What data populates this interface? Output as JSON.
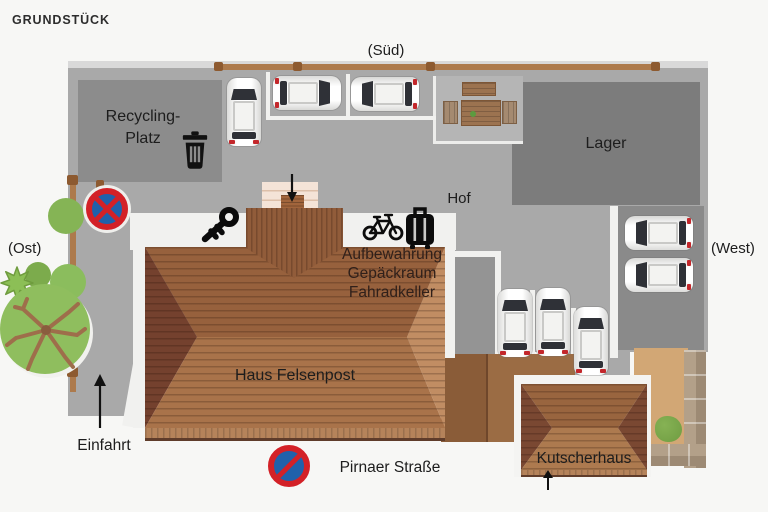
{
  "title": "GRUNDSTÜCK",
  "compass": {
    "south": "(Süd)",
    "east": "(Ost)",
    "west": "(West)"
  },
  "labels": {
    "recycling": [
      "Recycling-",
      "Platz"
    ],
    "lager": "Lager",
    "hof": "Hof",
    "storage": [
      "Aufbewahrung",
      "Gepäckraum",
      "Fahradkeller"
    ],
    "haus": "Haus Felsenpost",
    "kutscherhaus": "Kutscherhaus",
    "einfahrt": "Einfahrt",
    "street": "Pirnaer Straße"
  },
  "icons": {
    "trash": "trash-icon",
    "key": "key-icon",
    "bicycle": "bicycle-icon",
    "luggage": "luggage-icon",
    "no_stopping_sign": "round red-blue sign with X",
    "no_parking_sign": "round red-blue sign with slash",
    "arrows": [
      "entrance-down-arrow",
      "einfahrt-up-arrow",
      "kutscherhaus-up-arrow"
    ]
  },
  "counts": {
    "parked_cars": 8
  },
  "colors": {
    "background": "#f7f7f5",
    "ground_gray": "#a9a9a9",
    "building_gray": "#7c7c7c",
    "roof_brown": "#9a6744",
    "roof_dark": "#74412e",
    "roof_light": "#c18d63",
    "fence_brown": "#ad7a4c",
    "garden_tan": "#d2a775",
    "tree_green": "#8fbe5e",
    "sign_red": "#d32127",
    "sign_blue": "#2061ab"
  }
}
